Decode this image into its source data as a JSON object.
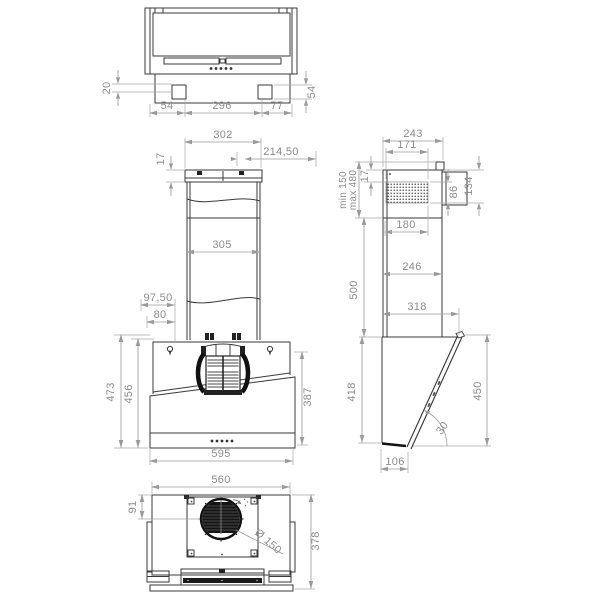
{
  "drawing": {
    "type": "technical-drawing",
    "subject": "wall-mounted cooker hood dimensional drawing",
    "units": "mm",
    "colors": {
      "outline": "#3a3a3a",
      "dark": "#141414",
      "dimension_line": "#9a9a9a",
      "dimension_text": "#8c8c8c",
      "background": "#ffffff"
    },
    "views": {
      "top": {
        "label": "top-view",
        "dims": {
          "depth_offset": "20",
          "side_height": "54",
          "left_margin": "54",
          "mount_spacing": "296",
          "right_margin": "77"
        }
      },
      "front": {
        "label": "front-view",
        "dims": {
          "bracket_width": "302",
          "flange_height": "17",
          "center_offset": "214,50",
          "chimney_width": "305",
          "hook_upper": "97,50",
          "hook_lower": "80",
          "total_height": "473",
          "inner_height": "456",
          "glass_height": "387",
          "body_width": "595"
        }
      },
      "side": {
        "label": "side-view",
        "dims": {
          "top_depth": "243",
          "vent_width": "171",
          "chimney_min": "min 150",
          "chimney_max": "max 480",
          "flange_height": "17",
          "vent_height": "86",
          "vent_total_height": "134",
          "lower_chimney_depth": "180",
          "chimney_height": "500",
          "chimney_depth": "246",
          "body_top_depth": "318",
          "rear_height": "418",
          "glass_length": "450",
          "glass_angle": "30",
          "bottom_depth": "106"
        }
      },
      "bottom": {
        "label": "bottom-view",
        "dims": {
          "width": "560",
          "outlet_offset": "91",
          "outlet_diameter": "Ø 150",
          "depth": "378"
        }
      }
    }
  }
}
